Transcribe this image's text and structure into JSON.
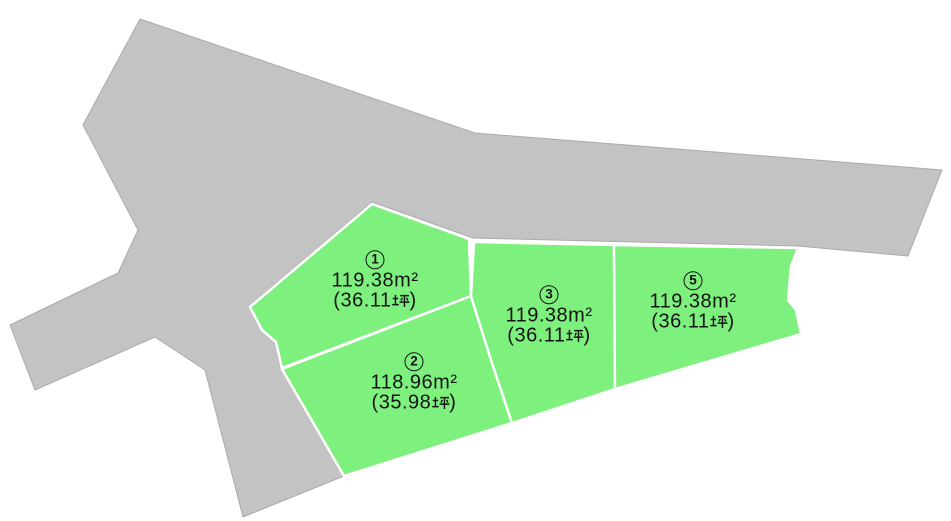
{
  "figure": {
    "kind": "land-plot-site-plan",
    "colors": {
      "background": "#ffffff",
      "road_fill": "#c3c3c3",
      "plot_fill": "#7df07d",
      "boundary_line": "#ffffff",
      "text": "#141414"
    }
  },
  "plots": [
    {
      "id": "plot-1",
      "number": "1",
      "circled_number_text": "①",
      "area_label": "119.38m²",
      "area_text": "119.38㎡",
      "area_m2": "119.38",
      "tsubo_value": "36.11",
      "tsubo_unit": "坪",
      "tsubo_text": "（36.11坪）",
      "tsubo_open": "(36.11",
      "tsubo_close": ")"
    },
    {
      "id": "plot-2",
      "number": "2",
      "circled_number_text": "②",
      "area_label": "118.96m²",
      "area_text": "118.96㎡",
      "area_m2": "118.96",
      "tsubo_value": "35.98",
      "tsubo_unit": "坪",
      "tsubo_text": "（35.98坪）",
      "tsubo_open": "(35.98",
      "tsubo_close": ")"
    },
    {
      "id": "plot-3",
      "number": "3",
      "circled_number_text": "③",
      "area_label": "119.38m²",
      "area_text": "119.38㎡",
      "area_m2": "119.38",
      "tsubo_value": "36.11",
      "tsubo_unit": "坪",
      "tsubo_text": "（36.11坪）",
      "tsubo_open": "(36.11",
      "tsubo_close": ")"
    },
    {
      "id": "plot-5",
      "number": "5",
      "circled_number_text": "⑤",
      "area_label": "119.38m²",
      "area_text": "119.38㎡",
      "area_m2": "119.38",
      "tsubo_value": "36.11",
      "tsubo_unit": "坪",
      "tsubo_text": "（36.11坪）",
      "tsubo_open": "(36.11",
      "tsubo_close": ")"
    }
  ]
}
